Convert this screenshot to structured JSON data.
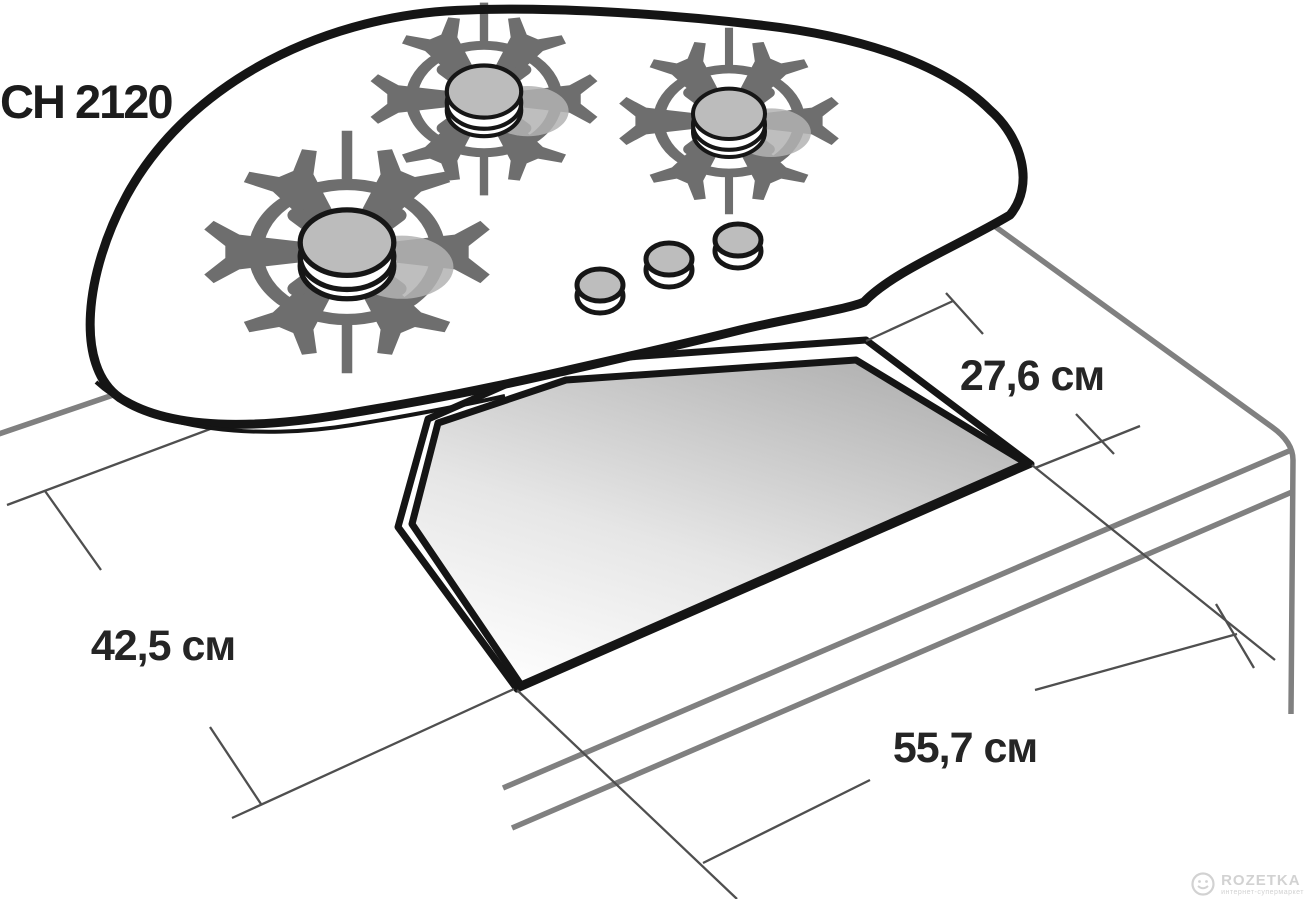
{
  "title": "CH 2120",
  "dimensions": {
    "width_label": "27,6 см",
    "depth_label": "42,5 см",
    "length_label": "55,7 см"
  },
  "watermark": {
    "brand": "ROZETKA",
    "tagline": "интернет-супермаркет"
  },
  "colors": {
    "outline_black": "#151515",
    "support_gray": "#6e6e6e",
    "cap_gray": "#bcbcbc",
    "shadow_gray": "#b3b3b3",
    "counter_gray": "#808080",
    "dimension_line_gray": "#4f4f4f",
    "cutout_shade_gray": "#b8b8b8",
    "watermark_gray": "#d2d2d2"
  }
}
